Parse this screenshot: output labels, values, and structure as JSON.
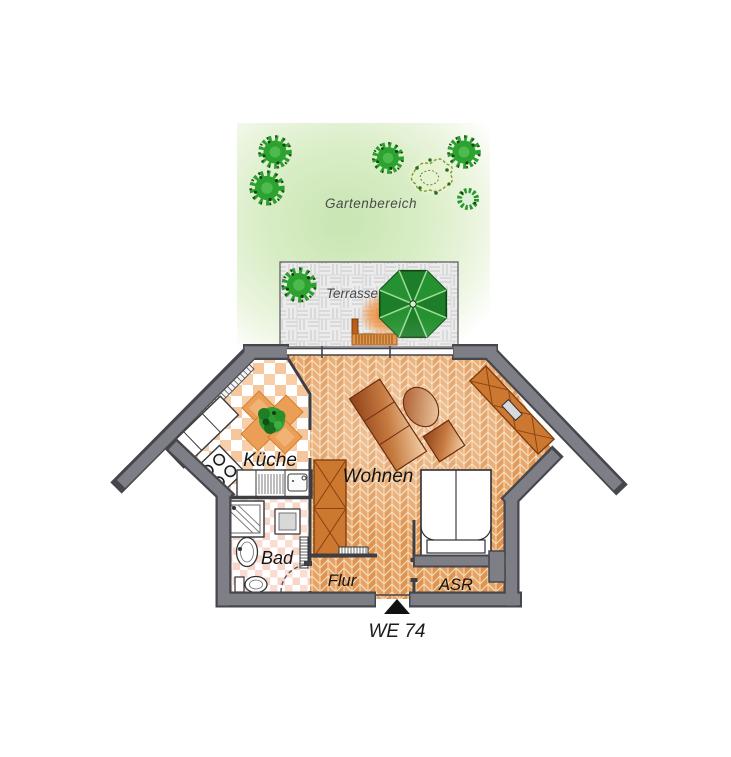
{
  "floorplan": {
    "unit_label": "WE 74",
    "outdoor": {
      "garden": {
        "label": "Gartenbereich"
      },
      "terrace": {
        "label": "Terrasse"
      }
    },
    "rooms": [
      {
        "id": "kueche",
        "label": "Küche"
      },
      {
        "id": "wohnen",
        "label": "Wohnen"
      },
      {
        "id": "bad",
        "label": "Bad"
      },
      {
        "id": "flur",
        "label": "Flur"
      },
      {
        "id": "asr",
        "label": "ASR"
      }
    ],
    "colors": {
      "wall": "#7e7e86",
      "wall_edge": "#46464d",
      "floor_parquet": "#df9350",
      "floor_parquet_alt": "#e7a365",
      "parquet_grout": "#f3dcb6",
      "kitchen_tile": "#f8cfa8",
      "bath_tile": "#fadcd2",
      "furniture_copper": "#b05a28",
      "cabinet_orange": "#cd7831",
      "umbrella_green": "#1c7e28",
      "tree_green": "#2aa02e",
      "garden_green": "#c8e5b2",
      "terrace_gray": "#ececec",
      "bench_orange": "#e08a30",
      "entrance_marker": "#111111"
    }
  }
}
